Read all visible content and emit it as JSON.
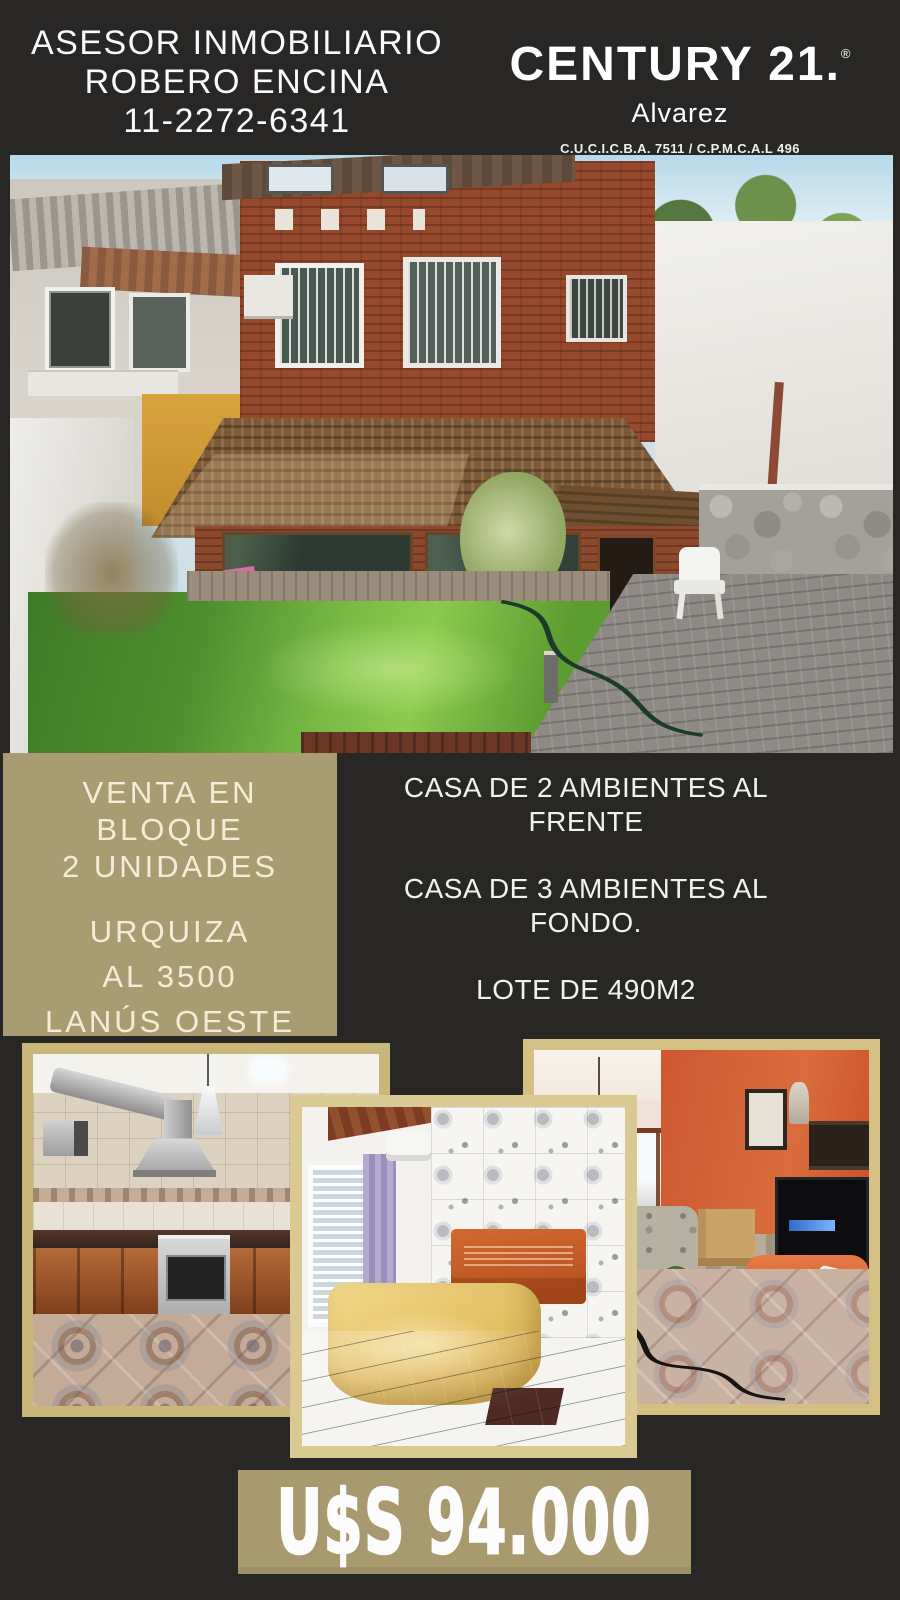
{
  "header": {
    "agent_title": "ASESOR INMOBILIARIO",
    "agent_name": "ROBERO ENCINA",
    "agent_phone": "11-2272-6341",
    "brand_name": "CENTURY 21.",
    "brand_reg": "®",
    "brand_office": "Alvarez",
    "brand_license": "C.U.C.I.C.B.A. 7511 / C.P.M.C.A.L 496"
  },
  "listing": {
    "sale_lines": [
      "VENTA EN",
      "BLOQUE",
      "2 UNIDADES"
    ],
    "address_lines": [
      "URQUIZA",
      "AL 3500",
      "LANÚS OESTE"
    ],
    "features": [
      "CASA DE 2 AMBIENTES AL FRENTE",
      "CASA DE 3 AMBIENTES AL FONDO.",
      "LOTE DE 490M2"
    ],
    "price": "U$S 94.000"
  },
  "photos": {
    "main_alt": "Patio trasero con casa de ladrillo, techo de tejas, jardín con césped, pared de piedra y silla plástica blanca",
    "kitchen_alt": "Cocina con alacenas de madera, campana de acero inoxidable y piso calcáreo",
    "bedroom_alt": "Dormitorio con acolchado amarillo, respaldo naranja, cortinas lilas y pared de azulejos floreados",
    "living_alt": "Living con paredes naranjas, sillón naranja, mesa ratona y mueble de TV oscuro"
  },
  "colors": {
    "background_dark": "#282725",
    "panel_tan": "#aa9c72",
    "price_tan": "#a89a6e",
    "frame_kitchen": "#c9b67b",
    "frame_bedroom": "#dbc993",
    "frame_living": "#d4c084",
    "cream_text": "#f4ecd9",
    "white_text": "#fafafa"
  }
}
